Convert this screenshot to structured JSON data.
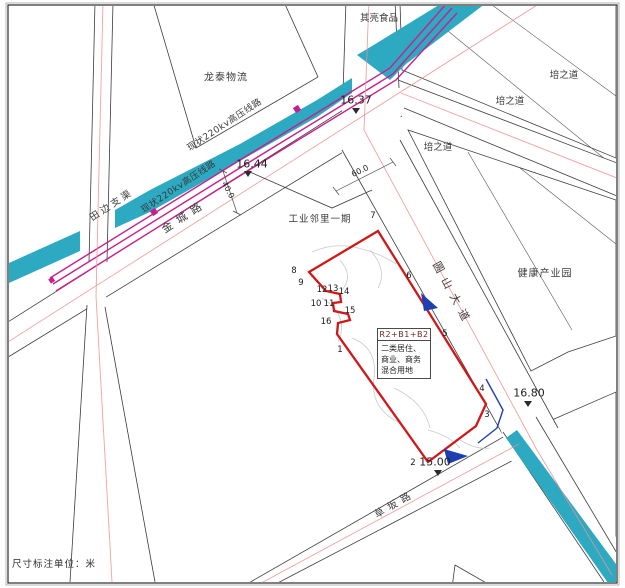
{
  "caption": "尺寸标注单位：米",
  "waterway_label": "田边支渠",
  "powerline_labels": [
    "现状220kv高压线路",
    "现状220kv高压线路"
  ],
  "roads": {
    "jincheng": "金城路",
    "yuanshan": "圆山大道",
    "caoban": "草坂路"
  },
  "parcels": {
    "longtai": "龙泰物流",
    "qiliang": "其亮食品",
    "peizhidao_1": "培之道",
    "peizhidao_2": "培之道",
    "peizhidao_3": "培之道",
    "health": "健康产业园",
    "industrial_phase1": "工业邻里一期"
  },
  "site": {
    "code": "R2+B1+B2",
    "land_use": "二类居住、商业、商务混合用地"
  },
  "elevations": {
    "n16_37": "16.37",
    "n16_44": "16.44",
    "n16_80": "16.80",
    "n15_00": "15.00"
  },
  "dimensions": {
    "road_yuanshan_width": "60.0",
    "road_jincheng_width": "40.0"
  },
  "vertices": [
    "1",
    "2",
    "3",
    "4",
    "5",
    "6",
    "7",
    "8",
    "9",
    "10",
    "11",
    "12",
    "13",
    "14",
    "15",
    "16"
  ],
  "colors": {
    "water": "#2da9c2",
    "powerline": "#c71f8f",
    "site_boundary": "#d01818",
    "centerline": "#f09090",
    "arrow": "#1d3fb0"
  }
}
